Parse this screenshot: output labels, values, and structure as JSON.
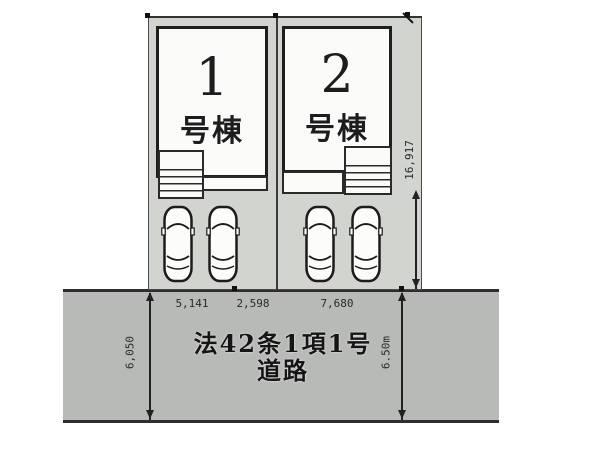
{
  "plan": {
    "buildings": [
      {
        "number": "1",
        "suffix": "号棟"
      },
      {
        "number": "2",
        "suffix": "号棟"
      }
    ],
    "road_label": {
      "line1": "法42条1項1号",
      "line2": "道路"
    },
    "dimensions": {
      "frontage_left": "5,141",
      "frontage_middle": "2,598",
      "frontage_right": "7,680",
      "depth_right": "16,917",
      "road_width_left": "6,050",
      "road_width_right": "6.50m"
    },
    "icons": {
      "car": "car-icon",
      "steps": "entry-steps"
    },
    "colors": {
      "road_fill": "#b7bab6",
      "lot_fill": "#d2d4d0",
      "building_fill": "#fbfbf9",
      "line": "#222222"
    }
  }
}
